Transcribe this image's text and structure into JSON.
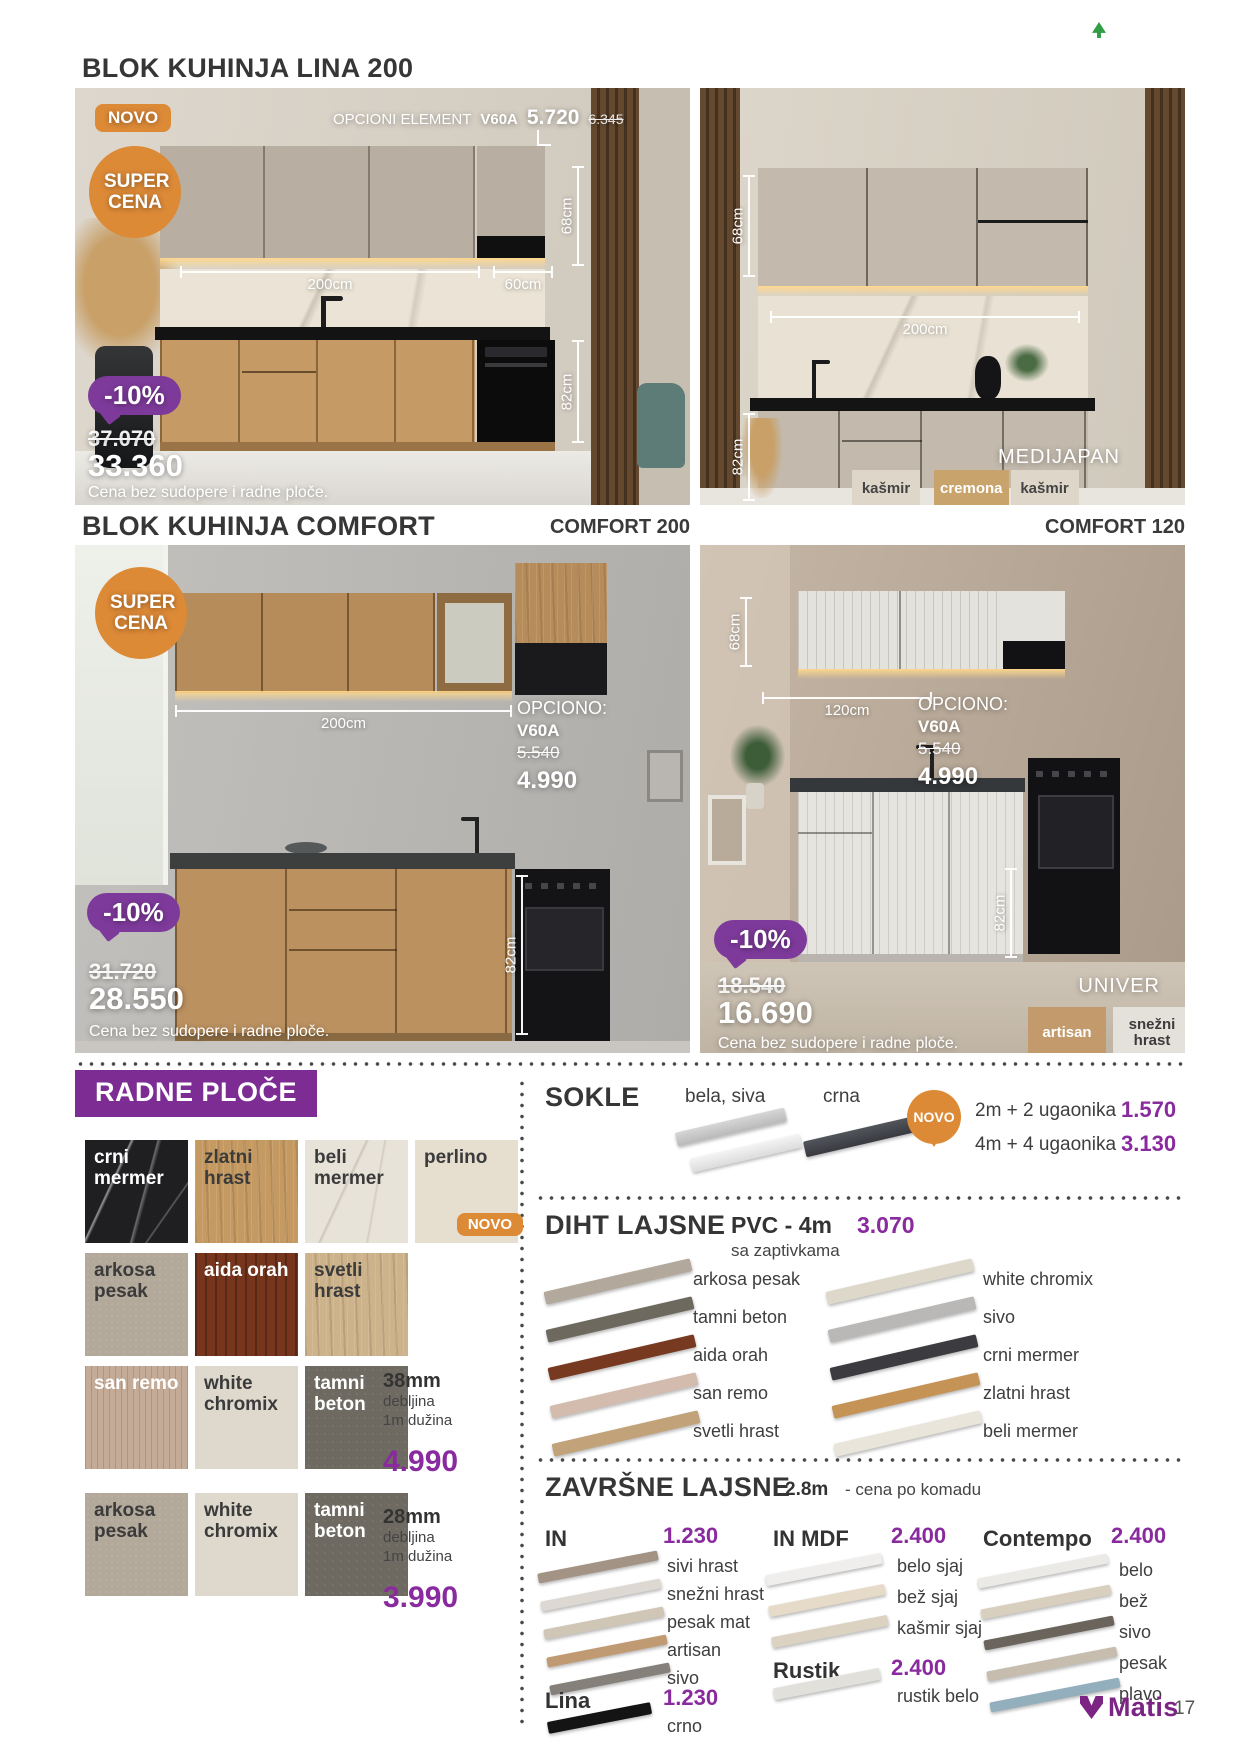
{
  "brand": {
    "name": "Matis",
    "page": "17"
  },
  "colors": {
    "orange": "#dd8a37",
    "purple_badge": "#7e3a9b",
    "purple_price": "#892a9e",
    "purple_header": "#7c2c92"
  },
  "lina": {
    "title": "BLOK KUHINJA LINA 200",
    "novo": "NOVO",
    "super_cena": "SUPER CENA",
    "opcioni": {
      "label": "OPCIONI ELEMENT",
      "code": "V60A",
      "price": "5.720",
      "old_price": "6.345"
    },
    "left": {
      "dim_top": "68cm",
      "dim_width": "200cm",
      "dim_width2": "60cm",
      "dim_bottom": "82cm",
      "discount": "-10%",
      "old_price": "37.070",
      "price": "33.360",
      "note": "Cena bez sudopere i radne ploče."
    },
    "right": {
      "dim_top": "68cm",
      "dim_width": "200cm",
      "dim_bottom": "82cm",
      "model": "MEDIJAPAN",
      "swatches": [
        {
          "label": "kašmir",
          "color": "#ddd6c9",
          "text": "#444444"
        },
        {
          "label": "cremona",
          "color": "#c8a36b",
          "text": "#ffffff"
        },
        {
          "label": "kašmir",
          "color": "#ddd6c9",
          "text": "#444444"
        }
      ]
    }
  },
  "comfort": {
    "title": "BLOK KUHINJA COMFORT",
    "label_200": "COMFORT 200",
    "label_120": "COMFORT 120",
    "super_cena": "SUPER CENA",
    "c200": {
      "dim_width": "200cm",
      "dim_bottom": "82cm",
      "opciono": {
        "label": "OPCIONO:",
        "code": "V60A",
        "old_price": "5.540",
        "price": "4.990"
      },
      "discount": "-10%",
      "old_price": "31.720",
      "price": "28.550",
      "note": "Cena bez sudopere i radne ploče."
    },
    "c120": {
      "dim_top": "68cm",
      "dim_width": "120cm",
      "dim_bottom": "82cm",
      "opciono": {
        "label": "OPCIONO:",
        "code": "V60A",
        "old_price": "5.540",
        "price": "4.990"
      },
      "discount": "-10%",
      "old_price": "18.540",
      "price": "16.690",
      "note": "Cena bez sudopere i radne ploče.",
      "model": "UNIVER",
      "swatches": [
        {
          "label": "artisan",
          "color": "#c29a6b",
          "text": "#ffffff"
        },
        {
          "label": "snežni hrast",
          "color": "#e4e1da",
          "text": "#3b3b3b"
        }
      ]
    }
  },
  "radne_ploce": {
    "title": "RADNE PLOČE",
    "novo": "NOVO",
    "rows": [
      [
        {
          "label": "crni mermer",
          "color": "#1f1f22",
          "text": "#ffffff",
          "tx": "marbleD"
        },
        {
          "label": "zlatni hrast",
          "color": "#c49a62",
          "text": "#3b3b3b",
          "tx": "wood"
        },
        {
          "label": "beli mermer",
          "color": "#e8e3d8",
          "text": "#3b3b3b",
          "tx": "marbleL"
        },
        {
          "label": "perlino",
          "color": "#e6dfd0",
          "text": "#3b3b3b",
          "tx": "plain",
          "novo": true
        }
      ],
      [
        {
          "label": "arkosa pesak",
          "color": "#b3a99b",
          "text": "#3b3b3b",
          "tx": "stone"
        },
        {
          "label": "aida orah",
          "color": "#76351c",
          "text": "#ffffff",
          "tx": "woodD"
        },
        {
          "label": "svetli hrast",
          "color": "#cdb38c",
          "text": "#3b3b3b",
          "tx": "wood"
        }
      ],
      [
        {
          "label": "san remo",
          "color": "#c4ab97",
          "text": "#ffffff",
          "tx": "woodV"
        },
        {
          "label": "white chromix",
          "color": "#ded9cc",
          "text": "#3b3b3b",
          "tx": "plain"
        },
        {
          "label": "tamni beton",
          "color": "#6e6a61",
          "text": "#ffffff",
          "tx": "concrete"
        }
      ],
      [
        {
          "label": "arkosa pesak",
          "color": "#b3a99b",
          "text": "#3b3b3b",
          "tx": "stone"
        },
        {
          "label": "white chromix",
          "color": "#ded9cc",
          "text": "#3b3b3b",
          "tx": "plain"
        },
        {
          "label": "tamni beton",
          "color": "#6e6a61",
          "text": "#ffffff",
          "tx": "concrete"
        }
      ]
    ],
    "t38": {
      "size": "38mm",
      "d1": "debljina",
      "d2": "1m dužina",
      "price": "4.990"
    },
    "t28": {
      "size": "28mm",
      "d1": "debljina",
      "d2": "1m dužina",
      "price": "3.990"
    }
  },
  "sokle": {
    "title": "SOKLE",
    "variant_light": "bela, siva",
    "variant_dark": "crna",
    "novo": "NOVO",
    "options": [
      {
        "label": "2m + 2 ugaonika",
        "price": "1.570"
      },
      {
        "label": "4m + 4 ugaonika",
        "price": "3.130"
      }
    ]
  },
  "diht": {
    "title": "DIHT LAJSNE",
    "type": "PVC - 4m",
    "price": "3.070",
    "note": "sa zaptivkama",
    "left_items": [
      {
        "label": "arkosa pesak",
        "color": "#b2a89b"
      },
      {
        "label": "tamni beton",
        "color": "#6e695f"
      },
      {
        "label": "aida orah",
        "color": "#77391f"
      },
      {
        "label": "san remo",
        "color": "#d3bcae"
      },
      {
        "label": "svetli hrast",
        "color": "#c2a379"
      }
    ],
    "right_items": [
      {
        "label": "white chromix",
        "color": "#ded8ca"
      },
      {
        "label": "sivo",
        "color": "#b9b8b6"
      },
      {
        "label": "crni mermer",
        "color": "#3b3b40"
      },
      {
        "label": "zlatni hrast",
        "color": "#c59356"
      },
      {
        "label": "beli mermer",
        "color": "#e9e5da"
      }
    ]
  },
  "zavrsne": {
    "title": "ZAVRŠNE LAJSNE",
    "size": "2.8m",
    "note": "- cena po komadu",
    "groups": [
      {
        "name": "IN",
        "price": "1.230",
        "items": [
          {
            "label": "sivi hrast",
            "color": "#a39384"
          },
          {
            "label": "snežni hrast",
            "color": "#ddd9d2"
          },
          {
            "label": "pesak mat",
            "color": "#cfc6b6"
          },
          {
            "label": "artisan",
            "color": "#c09a72"
          },
          {
            "label": "sivo",
            "color": "#85807a"
          }
        ]
      },
      {
        "name": "Lina",
        "price": "1.230",
        "items": [
          {
            "label": "crno",
            "color": "#141414"
          }
        ]
      },
      {
        "name": "IN MDF",
        "price": "2.400",
        "items": [
          {
            "label": "belo sjaj",
            "color": "#efeeec"
          },
          {
            "label": "bež sjaj",
            "color": "#e6dbc9"
          },
          {
            "label": "kašmir sjaj",
            "color": "#dcd2c2"
          }
        ]
      },
      {
        "name": "Rustik",
        "price": "2.400",
        "items": [
          {
            "label": "rustik belo",
            "color": "#e2e0db"
          }
        ]
      },
      {
        "name": "Contempo",
        "price": "2.400",
        "items": [
          {
            "label": "belo",
            "color": "#eceae6"
          },
          {
            "label": "bež",
            "color": "#d9cfbf"
          },
          {
            "label": "sivo",
            "color": "#6a645c"
          },
          {
            "label": "pesak",
            "color": "#c6bdae"
          },
          {
            "label": "plavo",
            "color": "#93aebc"
          }
        ]
      }
    ]
  }
}
